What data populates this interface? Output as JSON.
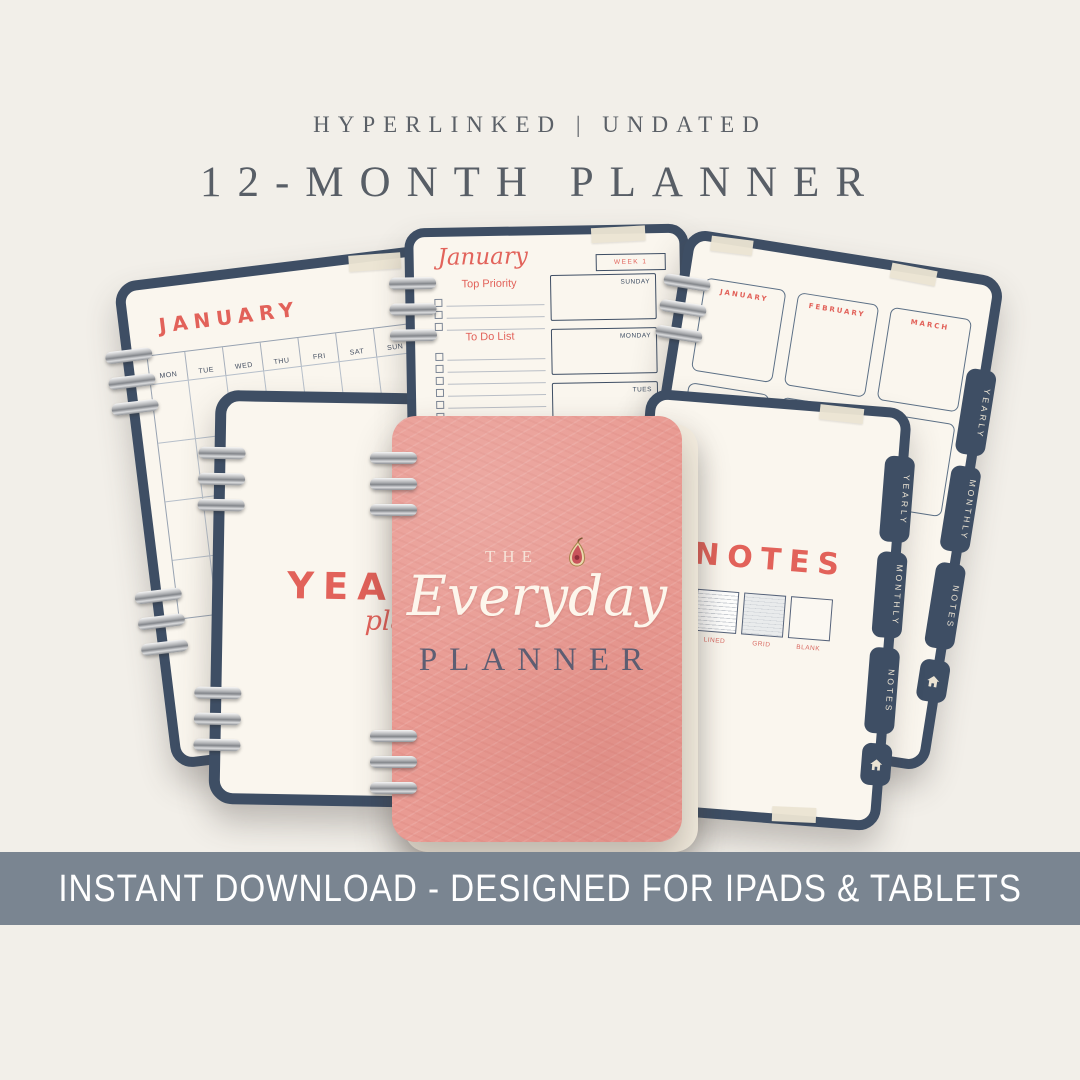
{
  "colors": {
    "background": "#f2efe9",
    "page_cream": "#faf6ee",
    "navy": "#3e4e64",
    "coral": "#e2625a",
    "cover_pink": "#e99b93",
    "banner_bg": "#7a8591",
    "banner_text": "#ffffff",
    "header_text": "#5b6067",
    "ring_silver": "#b9babc"
  },
  "header": {
    "tagline": "HYPERLINKED | UNDATED",
    "title": "12-MONTH PLANNER"
  },
  "banner": {
    "text": "INSTANT DOWNLOAD - DESIGNED FOR IPADS & TABLETS"
  },
  "cover": {
    "pre_title": "THE",
    "script_title": "Everyday",
    "caps_title": "PLANNER",
    "icon": "fig-icon"
  },
  "monthly_page": {
    "title": "JANUARY",
    "day_headers": [
      "MON",
      "TUE",
      "WED",
      "THU",
      "FRI",
      "SAT",
      "SUN"
    ]
  },
  "weekly_page": {
    "month_script": "January",
    "week_label": "WEEK 1",
    "top_priority_heading": "Top Priority",
    "todo_heading": "To Do List",
    "day_boxes": [
      "SUNDAY",
      "MONDAY",
      "TUES"
    ]
  },
  "yearly_overview_page": {
    "months": [
      "JANUARY",
      "FEBRUARY",
      "MARCH",
      "APRIL",
      "MAY",
      ""
    ]
  },
  "yearly_divider_page": {
    "title": "YEARLY",
    "subtitle": "planner"
  },
  "notes_page": {
    "title": "NOTES",
    "swatch_labels": [
      "LINED",
      "GRID",
      "BLANK"
    ]
  },
  "side_tabs": [
    "YEARLY",
    "MONTHLY",
    "NOTES"
  ]
}
